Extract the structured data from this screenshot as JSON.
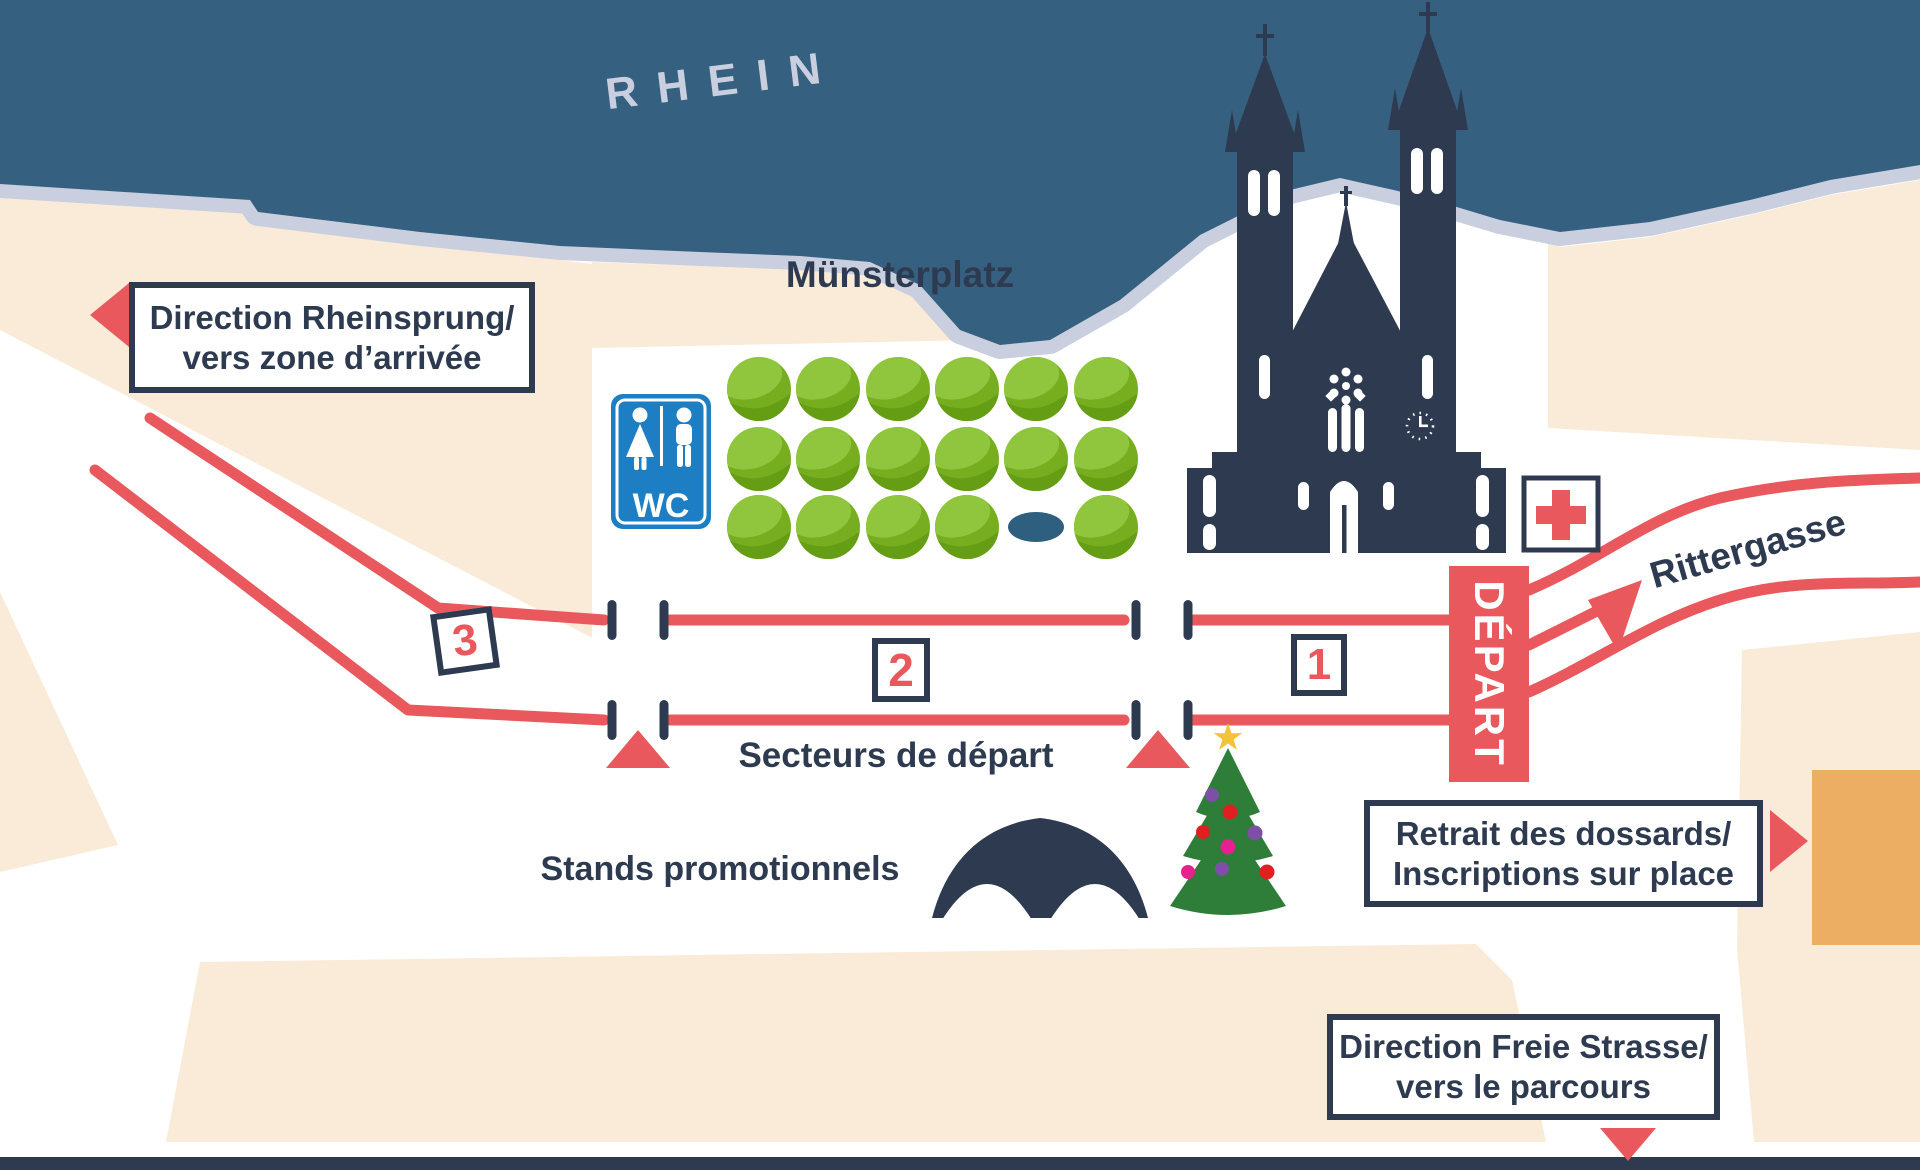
{
  "map": {
    "river": {
      "label": "RHEIN"
    },
    "places": {
      "muensterplatz": "Münsterplatz",
      "rittergasse": "Rittergasse"
    },
    "start_area": {
      "banner": "DÉPART",
      "sectors_label": "Secteurs de départ",
      "sectors": [
        "1",
        "2",
        "3"
      ]
    },
    "booths_label": "Stands promotionnels",
    "wc_label": "WC",
    "signs": {
      "rheinsprung": {
        "line1": "Direction Rheinsprung/",
        "line2": "vers zone d’arrivée"
      },
      "dossards": {
        "line1": "Retrait des dossards/",
        "line2": "Inscriptions sur place"
      },
      "freie_strasse": {
        "line1": "Direction Freie Strasse/",
        "line2": "vers le parcours"
      }
    },
    "icons": [
      "church-icon",
      "wc-icon",
      "first-aid-icon",
      "tent-icon",
      "christmas-tree-icon",
      "tree-icon",
      "pond-icon",
      "left-arrow-icon",
      "right-arrow-icon",
      "down-arrow-icon",
      "route-arrow-icon",
      "start-gate-icon",
      "start-triangle-icon"
    ],
    "colors": {
      "river": "#35607F",
      "shore": "#C9CFDF",
      "land": "#F9EBD8",
      "red": "#E8585C",
      "navy": "#2D3A50",
      "orange": "#EBAE62",
      "wcblue": "#1D7EC3",
      "tree": "#76AE20",
      "treelight": "#8FC63E",
      "treedark": "#659D15",
      "xmas": "#2E7D38",
      "gold": "#F2C238",
      "pond": "#2E5F7E"
    }
  }
}
